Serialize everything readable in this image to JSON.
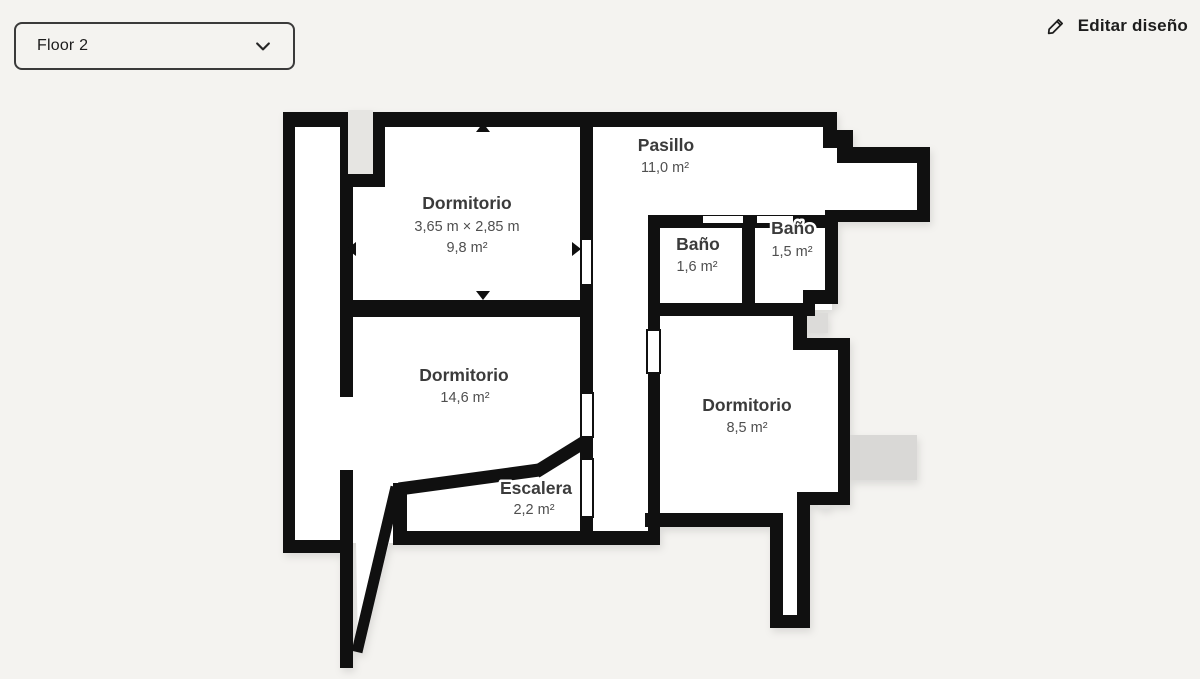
{
  "header": {
    "floor_selector": {
      "value": "Floor 2"
    },
    "edit_button": {
      "label": "Editar diseño"
    }
  },
  "floor_plan": {
    "rooms": [
      {
        "id": "dormitorio-1",
        "name": "Dormitorio",
        "dimensions": "3,65 m × 2,85 m",
        "area": "9,8 m²"
      },
      {
        "id": "pasillo",
        "name": "Pasillo",
        "area": "11,0 m²"
      },
      {
        "id": "bano-1",
        "name": "Baño",
        "area": "1,6 m²"
      },
      {
        "id": "bano-2",
        "name": "Baño",
        "area": "1,5 m²"
      },
      {
        "id": "dormitorio-2",
        "name": "Dormitorio",
        "area": "14,6 m²"
      },
      {
        "id": "dormitorio-3",
        "name": "Dormitorio",
        "area": "8,5 m²"
      },
      {
        "id": "escalera",
        "name": "Escalera",
        "area": "2,2 m²"
      }
    ]
  },
  "colors": {
    "background": "#f4f3f0",
    "wall": "#101010",
    "room_fill": "#ffffff",
    "adjacent_gray": "#d9d8d6",
    "niche_gray": "#e6e5e2",
    "label_text": "#3b3b3b"
  }
}
